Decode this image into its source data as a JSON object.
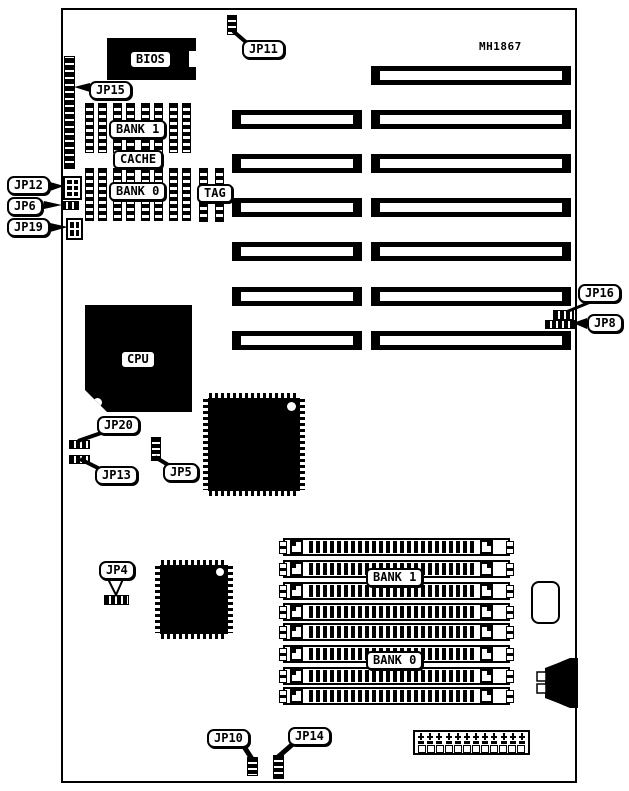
{
  "board_model": "MH1867",
  "chip_labels": {
    "bios": "BIOS",
    "cpu": "CPU",
    "cache_bank1": "BANK 1",
    "cache_title": "CACHE",
    "cache_bank0": "BANK 0",
    "tag": "TAG",
    "simm_bank1": "BANK 1",
    "simm_bank0": "BANK 0"
  },
  "jumper_labels": {
    "jp4": "JP4",
    "jp5": "JP5",
    "jp6": "JP6",
    "jp8": "JP8",
    "jp10": "JP10",
    "jp11": "JP11",
    "jp12": "JP12",
    "jp13": "JP13",
    "jp14": "JP14",
    "jp15": "JP15",
    "jp16": "JP16",
    "jp19": "JP19",
    "jp20": "JP20"
  },
  "expansion_slots": {
    "long_count": 7,
    "short_count": 6,
    "rows": [
      {
        "short": false,
        "long": true
      },
      {
        "short": true,
        "long": true
      },
      {
        "short": true,
        "long": true
      },
      {
        "short": true,
        "long": true
      },
      {
        "short": true,
        "long": true
      },
      {
        "short": true,
        "long": true
      },
      {
        "short": true,
        "long": true
      }
    ]
  },
  "cache_chips": {
    "row_bank1_count": 4,
    "row_bank0_count": 4,
    "tag_count": 2
  },
  "simm": {
    "socket_count": 8
  },
  "power_connector": {
    "pin_columns": 12
  },
  "jumper_blocks": {
    "jp12_pins": 6,
    "jp19_pins": 4
  },
  "colors": {
    "ink": "#000000",
    "paper": "#ffffff"
  }
}
